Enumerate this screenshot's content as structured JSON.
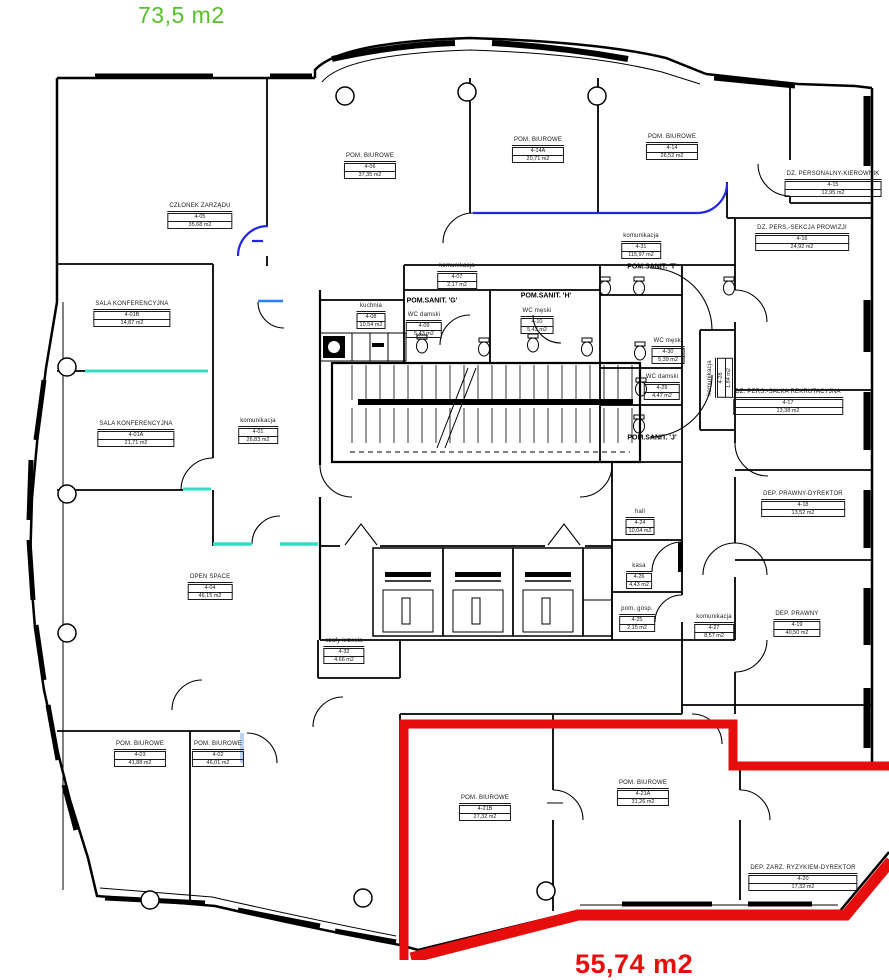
{
  "legend": {
    "top_area_text": "73,5 m2",
    "top_area_color": "#56c02b",
    "bottom_area_text": "55,74 m2",
    "bottom_area_color": "#e60d0d",
    "highlight_color": "#e60d0d"
  },
  "rooms": [
    {
      "name": "CZŁONEK ZARZĄDU",
      "number": "4-05",
      "area": "35,68 m2",
      "x": 200,
      "y": 216,
      "vertical": false
    },
    {
      "name": "POM. BIUROWE",
      "number": "4-06",
      "area": "37,35 m2",
      "x": 370,
      "y": 166,
      "vertical": false
    },
    {
      "name": "POM. BIUROWE",
      "number": "4-14A",
      "area": "20,71 m2",
      "x": 538,
      "y": 150,
      "vertical": false
    },
    {
      "name": "POM. BIUROWE",
      "number": "4-14",
      "area": "26,52 m2",
      "x": 672,
      "y": 147,
      "vertical": false
    },
    {
      "name": "DZ. PERSONALNY-KIEROWNIK",
      "number": "4-15",
      "area": "12,95 m2",
      "x": 833,
      "y": 184,
      "vertical": false
    },
    {
      "name": "DZ. PERS.-SEKCJA PROWIZJI",
      "number": "4-16",
      "area": "24,92 m2",
      "x": 802,
      "y": 238,
      "vertical": false
    },
    {
      "name": "komunikacja",
      "number": "4-31",
      "area": "115,97 m2",
      "x": 641,
      "y": 246,
      "vertical": false
    },
    {
      "name": "SALA KONFERENCYJNA",
      "number": "4-01B",
      "area": "14,87 m2",
      "x": 132,
      "y": 314,
      "vertical": false
    },
    {
      "name": "kuchnia",
      "number": "4-08",
      "area": "10,54 m2",
      "x": 371,
      "y": 316,
      "vertical": false
    },
    {
      "name": "WC damski",
      "number": "4-09",
      "area": "5,43 m2",
      "x": 424,
      "y": 325,
      "vertical": false
    },
    {
      "name": "WC męski",
      "number": "4-10",
      "area": "5,43 m2",
      "x": 537,
      "y": 321,
      "vertical": false
    },
    {
      "name": "komunikacja",
      "number": "4-07",
      "area": "2,17 m2",
      "x": 457,
      "y": 276,
      "vertical": false
    },
    {
      "name": "WC męski",
      "number": "4-30",
      "area": "5,39 m2",
      "x": 668,
      "y": 351,
      "vertical": false
    },
    {
      "name": "WC damski",
      "number": "4-29",
      "area": "4,47 m2",
      "x": 662,
      "y": 387,
      "vertical": false
    },
    {
      "name": "komunikacja",
      "number": "4-28",
      "area": "1,84 m2",
      "x": 720,
      "y": 378,
      "vertical": true
    },
    {
      "name": "SALA KONFERENCYJNA",
      "number": "4-01A",
      "area": "21,71 m2",
      "x": 136,
      "y": 434,
      "vertical": false
    },
    {
      "name": "komunikacja",
      "number": "4-01",
      "area": "26,83 m2",
      "x": 258,
      "y": 431,
      "vertical": false
    },
    {
      "name": "DZ. PERS.-SALKA REKRUTACYJNA",
      "number": "4-17",
      "area": "13,38 m2",
      "x": 788,
      "y": 402,
      "vertical": false
    },
    {
      "name": "DEP. PRAWNY-DYREKTOR",
      "number": "4-18",
      "area": "13,52 m2",
      "x": 803,
      "y": 504,
      "vertical": false
    },
    {
      "name": "hall",
      "number": "4-24",
      "area": "10,04 m2",
      "x": 640,
      "y": 522,
      "vertical": false
    },
    {
      "name": "OPEN SPACE",
      "number": "4-04",
      "area": "46,15 m2",
      "x": 210,
      "y": 587,
      "vertical": false
    },
    {
      "name": "kasa",
      "number": "4-26",
      "area": "4,43 m2",
      "x": 639,
      "y": 576,
      "vertical": false
    },
    {
      "name": "pom. gosp.",
      "number": "4-25",
      "area": "2,15 m2",
      "x": 637,
      "y": 619,
      "vertical": false
    },
    {
      "name": "komunikacja",
      "number": "4-27",
      "area": "8,57 m2",
      "x": 714,
      "y": 627,
      "vertical": false
    },
    {
      "name": "DEP. PRAWNY",
      "number": "4-19",
      "area": "40,50 m2",
      "x": 797,
      "y": 624,
      "vertical": false
    },
    {
      "name": "szafy krzesła",
      "number": "4-32",
      "area": "4,66 m2",
      "x": 344,
      "y": 651,
      "vertical": false
    },
    {
      "name": "POM. BIUROWE",
      "number": "4-03",
      "area": "41,88 m2",
      "x": 140,
      "y": 754,
      "vertical": false
    },
    {
      "name": "POM. BIUROWE",
      "number": "4-02",
      "area": "46,01 m2",
      "x": 218,
      "y": 754,
      "vertical": false
    },
    {
      "name": "POM. BIUROWE",
      "number": "4-21B",
      "area": "27,32 m2",
      "x": 485,
      "y": 808,
      "vertical": false
    },
    {
      "name": "POM. BIUROWE",
      "number": "4-21A",
      "area": "31,26 m2",
      "x": 643,
      "y": 793,
      "vertical": false
    },
    {
      "name": "DEP. ZARZ. RYZYKIEM-DYREKTOR",
      "number": "4-20",
      "area": "17,32 m2",
      "x": 803,
      "y": 878,
      "vertical": false
    }
  ],
  "sanit_labels": [
    {
      "text": "POM.SANIT. 'G'",
      "x": 432,
      "y": 301
    },
    {
      "text": "POM.SANIT. 'H'",
      "x": 546,
      "y": 296
    },
    {
      "text": "POM.SANIT. 'T'",
      "x": 652,
      "y": 267
    },
    {
      "text": "POM.SANIT. 'J'",
      "x": 652,
      "y": 438
    }
  ]
}
